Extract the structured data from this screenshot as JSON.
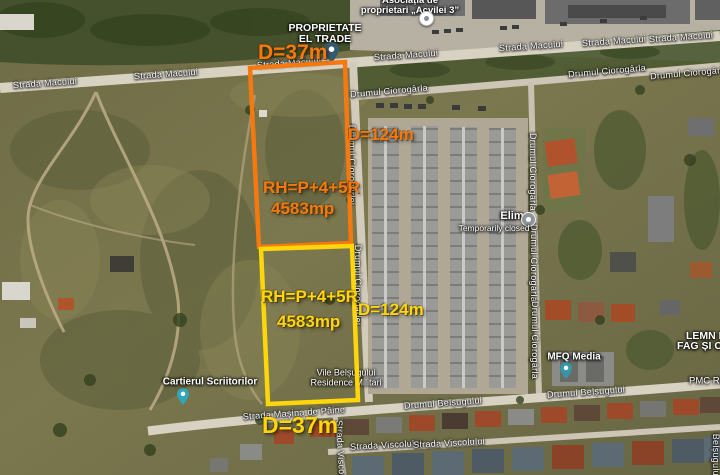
{
  "map": {
    "annotations": {
      "plot_top": {
        "color": "#f5790f",
        "dim_top": "D=37m",
        "dim_side": "D=124m",
        "height_regime": "RH=P+4+5R",
        "area": "4583mp"
      },
      "plot_bottom": {
        "color": "#ffd60a",
        "dim_bottom": "D=37m",
        "dim_side": "D=124m",
        "height_regime": "RH=P+4+5R",
        "area": "4583mp"
      }
    },
    "streets": [
      {
        "text": "Strada Macului"
      },
      {
        "text": "Strada Macului"
      },
      {
        "text": "Strada Macului"
      },
      {
        "text": "Strada Macului"
      },
      {
        "text": "Strada Macului"
      },
      {
        "text": "Strada Macului"
      },
      {
        "text": "Strada Macului"
      },
      {
        "text": "Drumul Ciorogârla"
      },
      {
        "text": "Drumul Ciorogârla"
      },
      {
        "text": "Drumul Ciorogârla"
      },
      {
        "text": "Drumul Ciorogârlei"
      },
      {
        "text": "Drumul Ciorogârlei"
      },
      {
        "text": "Drumul Ciorogârla"
      },
      {
        "text": "Drumul Ciorogârla"
      },
      {
        "text": "Drumul Ciorogârla"
      },
      {
        "text": "Drumul Belșugului"
      },
      {
        "text": "Drumul Belșugului"
      },
      {
        "text": "Strada Mașina de Pâine"
      },
      {
        "text": "Strada Viscolului"
      },
      {
        "text": "Strada Viscolului"
      },
      {
        "text": "Strada Viscolului"
      },
      {
        "text": "Belșugului"
      }
    ],
    "pois": {
      "association": {
        "line1": "Asociația de",
        "line2": "proprietari „Acvilei 3”"
      },
      "el_trade": {
        "line1": "PROPRIETATE",
        "line2": "EL TRADE"
      },
      "elim": {
        "name": "Elim",
        "status": "Temporarily closed"
      },
      "mfq_media": {
        "name": "MFQ Media"
      },
      "cartierul_scriitorilor": {
        "name": "Cartierul Scriitorilor"
      },
      "vile_belsugului": {
        "line1": "Vile Belșugului",
        "line2": "Residence Militari"
      },
      "lemn": {
        "line1": "LEMN DE",
        "line2": "FAG ȘI CAR"
      },
      "pmc": {
        "name": "PMC Rom"
      }
    }
  }
}
